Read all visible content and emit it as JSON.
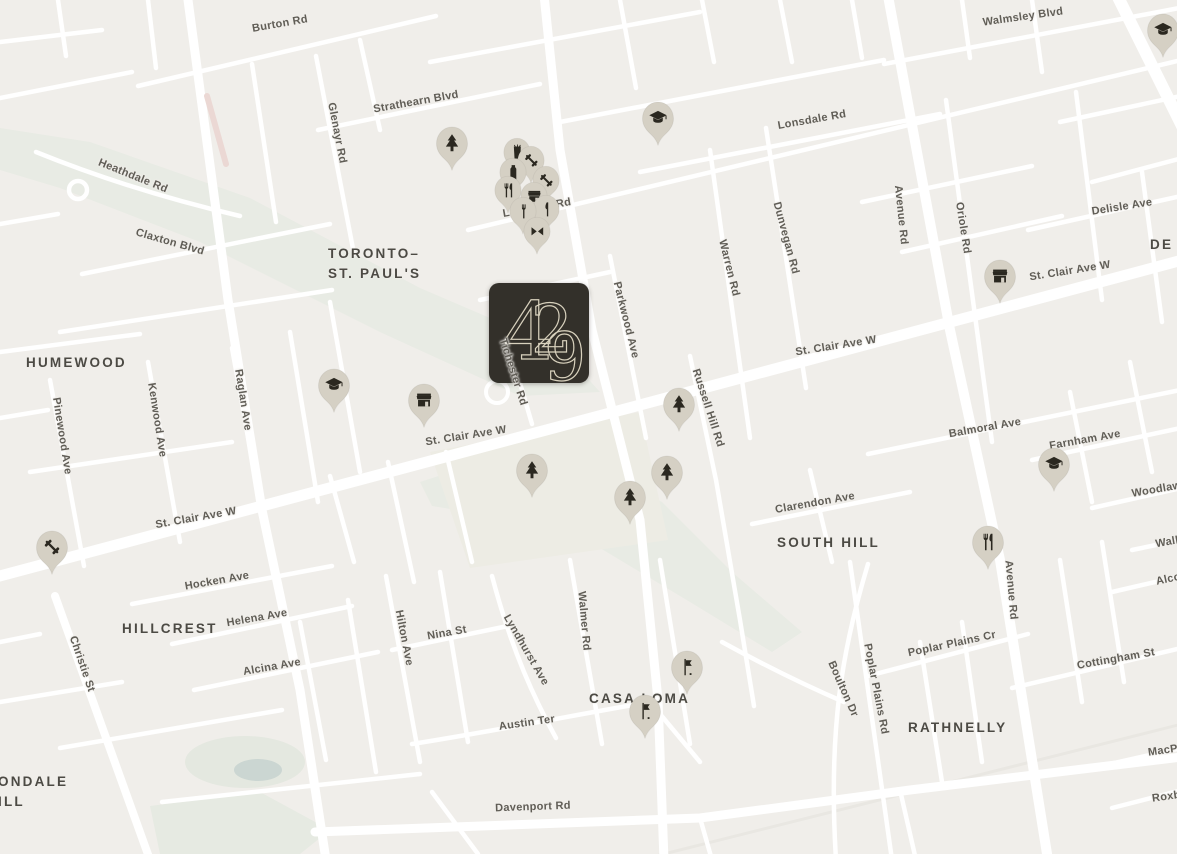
{
  "map": {
    "background_color": "#f0eeea",
    "road_color": "#ffffff",
    "park_color": "#e8ebe4",
    "field_color": "#edece4",
    "water_color": "#cbd6d2",
    "highlight_road_color": "#ebd8d4",
    "pin_color": "#d5d0c4",
    "pin_icon_color": "#2b2820",
    "street_label_color": "#605d56",
    "neighborhood_label_color": "#4c4a44"
  },
  "logo": {
    "text": "429",
    "background_color": "#33302a",
    "text_color": "#d8d1bd",
    "x": 489,
    "y": 283,
    "size": 100
  },
  "neighborhoods": [
    {
      "lines": [
        "HUMEWOOD"
      ],
      "x": 26,
      "y": 353
    },
    {
      "lines": [
        "TORONTO–",
        "ST. PAUL'S"
      ],
      "x": 328,
      "y": 244
    },
    {
      "lines": [
        "DE"
      ],
      "x": 1150,
      "y": 235
    },
    {
      "lines": [
        "SOUTH HILL"
      ],
      "x": 777,
      "y": 533
    },
    {
      "lines": [
        "HILLCREST"
      ],
      "x": 122,
      "y": 619
    },
    {
      "lines": [
        "CASA LOMA"
      ],
      "x": 589,
      "y": 689
    },
    {
      "lines": [
        "RATHNELLY"
      ],
      "x": 908,
      "y": 718
    },
    {
      "lines": [
        "ONDALE",
        "ILL"
      ],
      "x": -2,
      "y": 772
    }
  ],
  "streets": [
    {
      "name": "Burton Rd",
      "x": 280,
      "y": 24,
      "rot": -10
    },
    {
      "name": "Walmsley Blvd",
      "x": 1023,
      "y": 17,
      "rot": -8
    },
    {
      "name": "Strathearn Blvd",
      "x": 416,
      "y": 102,
      "rot": -10
    },
    {
      "name": "Glenayr Rd",
      "x": 337,
      "y": 133,
      "rot": 79
    },
    {
      "name": "Lonsdale Rd",
      "x": 812,
      "y": 120,
      "rot": -10
    },
    {
      "name": "Heathdale Rd",
      "x": 133,
      "y": 176,
      "rot": 22
    },
    {
      "name": "Claxton Blvd",
      "x": 170,
      "y": 242,
      "rot": 16
    },
    {
      "name": "Lonsdale Rd",
      "x": 537,
      "y": 208,
      "rot": -10
    },
    {
      "name": "Delisle Ave",
      "x": 1122,
      "y": 207,
      "rot": -9
    },
    {
      "name": "Avenue Rd",
      "x": 901,
      "y": 215,
      "rot": 84
    },
    {
      "name": "Oriole Rd",
      "x": 963,
      "y": 228,
      "rot": 81
    },
    {
      "name": "Dunvegan Rd",
      "x": 786,
      "y": 238,
      "rot": 75
    },
    {
      "name": "Warren Rd",
      "x": 729,
      "y": 268,
      "rot": 76
    },
    {
      "name": "St. Clair Ave W",
      "x": 1070,
      "y": 271,
      "rot": -9
    },
    {
      "name": "Parkwood Ave",
      "x": 626,
      "y": 320,
      "rot": 76
    },
    {
      "name": "St. Clair Ave W",
      "x": 836,
      "y": 346,
      "rot": -9
    },
    {
      "name": "Tichester Rd",
      "x": 513,
      "y": 372,
      "rot": 72
    },
    {
      "name": "Russell Hill Rd",
      "x": 708,
      "y": 408,
      "rot": 72
    },
    {
      "name": "Raglan Ave",
      "x": 243,
      "y": 400,
      "rot": 81
    },
    {
      "name": "Kenwood Ave",
      "x": 157,
      "y": 420,
      "rot": 81
    },
    {
      "name": "Pinewood Ave",
      "x": 62,
      "y": 436,
      "rot": 81
    },
    {
      "name": "St. Clair Ave W",
      "x": 466,
      "y": 436,
      "rot": -9
    },
    {
      "name": "Balmoral Ave",
      "x": 985,
      "y": 428,
      "rot": -10
    },
    {
      "name": "Farnham Ave",
      "x": 1085,
      "y": 440,
      "rot": -10
    },
    {
      "name": "Woodlawn",
      "x": 1160,
      "y": 489,
      "rot": -10
    },
    {
      "name": "Clarendon Ave",
      "x": 815,
      "y": 503,
      "rot": -10
    },
    {
      "name": "St. Clair Ave W",
      "x": 196,
      "y": 518,
      "rot": -10
    },
    {
      "name": "Walker",
      "x": 1174,
      "y": 541,
      "rot": -10
    },
    {
      "name": "Hocken Ave",
      "x": 217,
      "y": 581,
      "rot": -10
    },
    {
      "name": "Alcorn",
      "x": 1174,
      "y": 578,
      "rot": -12
    },
    {
      "name": "Helena Ave",
      "x": 257,
      "y": 618,
      "rot": -10
    },
    {
      "name": "Avenue Rd",
      "x": 1011,
      "y": 590,
      "rot": 85
    },
    {
      "name": "Christie St",
      "x": 82,
      "y": 664,
      "rot": 71
    },
    {
      "name": "Nina St",
      "x": 447,
      "y": 633,
      "rot": -10
    },
    {
      "name": "Hilton Ave",
      "x": 404,
      "y": 638,
      "rot": 79
    },
    {
      "name": "Alcina Ave",
      "x": 272,
      "y": 667,
      "rot": -10
    },
    {
      "name": "Lyndhurst Ave",
      "x": 526,
      "y": 650,
      "rot": 60
    },
    {
      "name": "Walmer Rd",
      "x": 584,
      "y": 621,
      "rot": 85
    },
    {
      "name": "Poplar Plains Cr",
      "x": 952,
      "y": 644,
      "rot": -12
    },
    {
      "name": "Poplar Plains Rd",
      "x": 876,
      "y": 689,
      "rot": 79
    },
    {
      "name": "Boulton Dr",
      "x": 843,
      "y": 689,
      "rot": 66
    },
    {
      "name": "Cottingham St",
      "x": 1116,
      "y": 659,
      "rot": -10
    },
    {
      "name": "Austin Ter",
      "x": 527,
      "y": 723,
      "rot": -8
    },
    {
      "name": "MacPherson",
      "x": 1182,
      "y": 748,
      "rot": -8
    },
    {
      "name": "Davenport Rd",
      "x": 533,
      "y": 807,
      "rot": -2
    },
    {
      "name": "Roxborough",
      "x": 1186,
      "y": 794,
      "rot": -8
    }
  ],
  "pois": [
    {
      "icon": "graduation-cap-icon",
      "x": 1163,
      "y": 30
    },
    {
      "icon": "graduation-cap-icon",
      "x": 658,
      "y": 118
    },
    {
      "icon": "tree-icon",
      "x": 452,
      "y": 143
    },
    {
      "icon": "drink-cup-icon",
      "x": 517,
      "y": 152,
      "size": 34
    },
    {
      "icon": "dumbbell-icon",
      "x": 531,
      "y": 160,
      "size": 34
    },
    {
      "icon": "bottle-icon",
      "x": 513,
      "y": 172,
      "size": 34
    },
    {
      "icon": "dumbbell-icon",
      "x": 546,
      "y": 180,
      "size": 34
    },
    {
      "icon": "restaurant-icon",
      "x": 508,
      "y": 190,
      "size": 34
    },
    {
      "icon": "storefront-icon",
      "x": 534,
      "y": 196,
      "size": 34
    },
    {
      "icon": "knife-icon",
      "x": 546,
      "y": 209,
      "size": 34
    },
    {
      "icon": "fork-icon",
      "x": 523,
      "y": 211,
      "size": 34
    },
    {
      "icon": "bowtie-icon",
      "x": 537,
      "y": 231,
      "size": 34
    },
    {
      "icon": "storefront-icon",
      "x": 1000,
      "y": 276
    },
    {
      "icon": "graduation-cap-icon",
      "x": 334,
      "y": 385
    },
    {
      "icon": "storefront-icon",
      "x": 424,
      "y": 400
    },
    {
      "icon": "tree-icon",
      "x": 679,
      "y": 404
    },
    {
      "icon": "graduation-cap-icon",
      "x": 1054,
      "y": 464
    },
    {
      "icon": "tree-icon",
      "x": 532,
      "y": 470
    },
    {
      "icon": "tree-icon",
      "x": 667,
      "y": 472
    },
    {
      "icon": "tree-icon",
      "x": 630,
      "y": 497
    },
    {
      "icon": "restaurant-icon",
      "x": 988,
      "y": 542
    },
    {
      "icon": "dumbbell-icon",
      "x": 52,
      "y": 547
    },
    {
      "icon": "flag-icon",
      "x": 687,
      "y": 667
    },
    {
      "icon": "flag-icon",
      "x": 645,
      "y": 711
    }
  ]
}
